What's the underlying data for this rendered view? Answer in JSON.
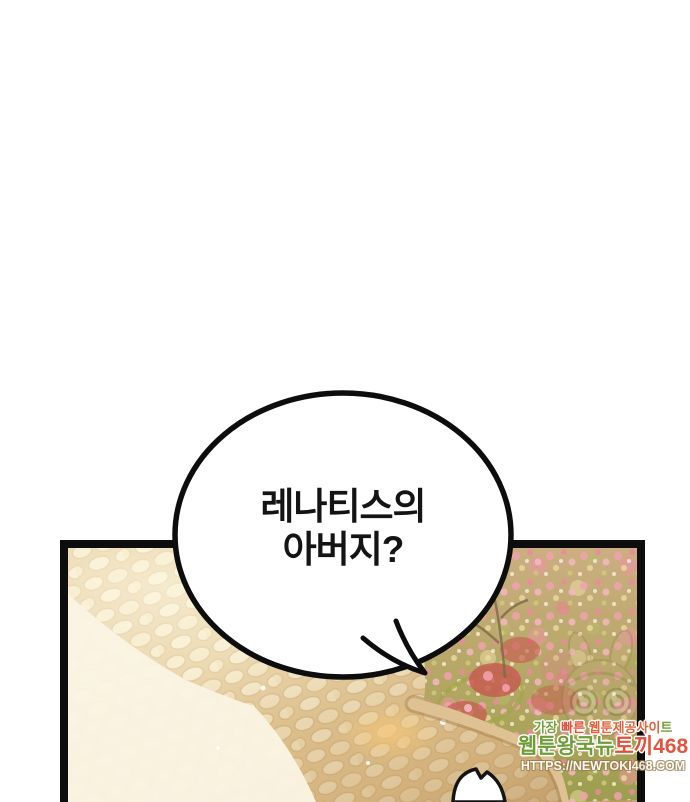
{
  "page": {
    "width": 690,
    "height": 800,
    "background": "#ffffff"
  },
  "speech_bubble": {
    "line1": "레나티스의",
    "line2": "아버지?",
    "fill": "#ffffff",
    "outline": "#0d0d0d",
    "text_color": "#141414"
  },
  "panel": {
    "border_color": "#0d0d0d",
    "scene": {
      "path_base": "#e8d2a2",
      "stone_fill": "#f5e9c8",
      "stone_edge": "#d9bd8c",
      "path_highlight": "#fbf4e0",
      "path_shadow": "#b98a4e",
      "light_triangle": "#faf4e2",
      "edge_strip": "#dfc293",
      "edge_strip_line": "#ac8550",
      "garden_top": "#ccae82",
      "garden_mid": "#b5a765",
      "garden_bottom": "#9c9e4e",
      "flower_pink": "#f0a1ae",
      "flower_pink_deep": "#ea8b9b",
      "flower_cream": "#ecd9a0",
      "bush_red": "#c6594f",
      "bed_ring": "#a3a64b",
      "glow": "#f8c878",
      "sparkle": "#ffffff",
      "figure_fill": "#ffffff",
      "figure_outline": "#141414"
    }
  },
  "watermark": {
    "line1_segments": [
      {
        "text": "가장 ",
        "color": "#72a03a"
      },
      {
        "text": "빠른 ",
        "color": "#e1503a"
      },
      {
        "text": "웹툰제공사이",
        "color": "#e4633c"
      },
      {
        "text": "트",
        "color": "#72a03a"
      }
    ],
    "line2_segments": [
      {
        "text": "웹툰왕국뉴",
        "color": "#6f9d38"
      },
      {
        "text": "토끼",
        "color": "#e1503a"
      },
      {
        "text": "468",
        "color": "#e4553f"
      }
    ],
    "url": "HTTPS://NEWTOKI468.COM",
    "url_color": "#ffffff"
  },
  "mascot": {
    "name": "newtoki rabbit mascot (ghosted watermark)"
  }
}
